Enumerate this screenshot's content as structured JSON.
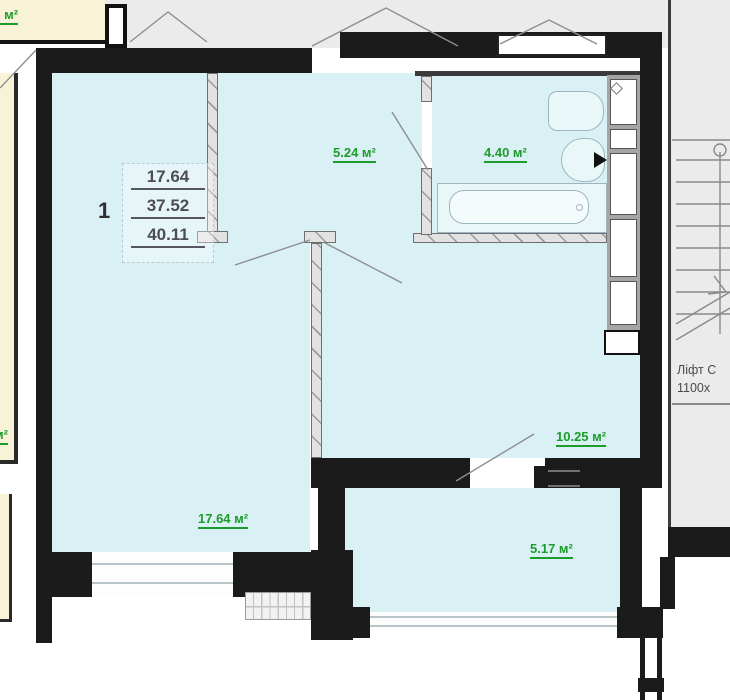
{
  "floor_plan": {
    "unit_summary": {
      "unit_number": "1",
      "living_area": "17.64",
      "total_area": "37.52",
      "overall_area": "40.11"
    },
    "room_labels": {
      "storage": "5.24 м²",
      "bathroom": "4.40 м²",
      "hallway": "10.25 м²",
      "living_room": "17.64 м²",
      "balcony": "5.17 м²"
    },
    "neighbor_labels": {
      "top_left_partial": "43 м²",
      "left_edge_partial": "м²"
    },
    "stairwell": {
      "line1": "Ліфт С",
      "line2": "1100х"
    },
    "colors": {
      "room_fill": "#d9f1f4",
      "neighbor_fill": "#f8f3d6",
      "outside_fill": "#ebebeb",
      "wall": "#1b1b1b",
      "area_text": "#1e9b2d"
    }
  }
}
